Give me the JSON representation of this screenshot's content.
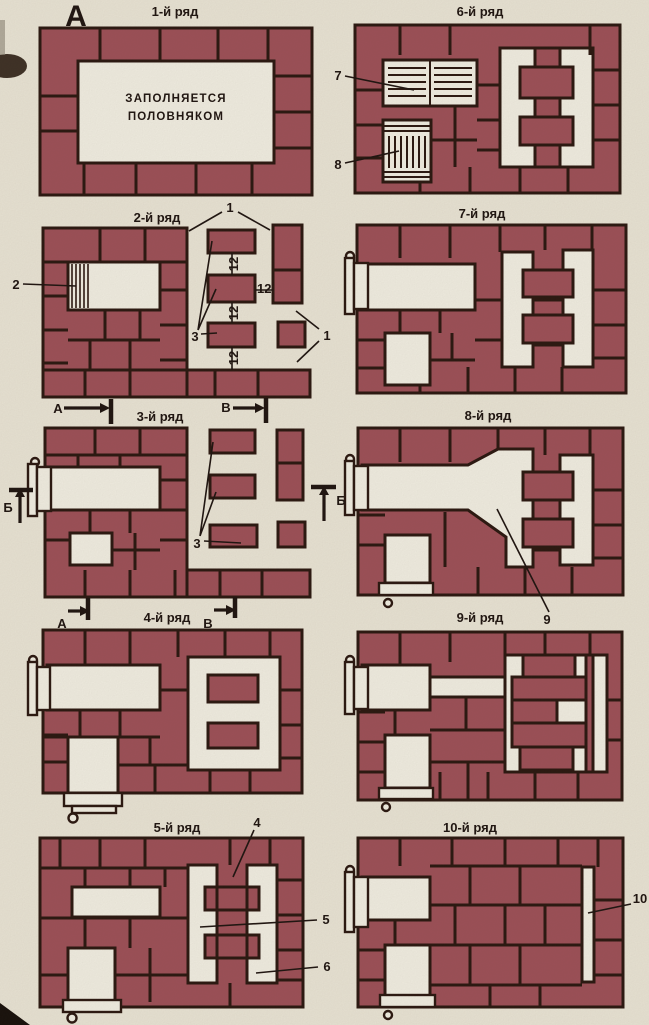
{
  "figure_label": "А",
  "colors": {
    "paper": "#e8e3d4",
    "brick": "#9c4f57",
    "outline": "#2a1710",
    "opening": "#f0ede1",
    "ink": "#1e1410"
  },
  "panels": [
    {
      "title": "1-й ряд",
      "note_line1": "ЗАПОЛНЯЕТСЯ",
      "note_line2": "ПОЛОВНЯКОМ"
    },
    {
      "title": "2-й ряд"
    },
    {
      "title": "3-й ряд"
    },
    {
      "title": "4-й ряд"
    },
    {
      "title": "5-й ряд"
    },
    {
      "title": "6-й ряд"
    },
    {
      "title": "7-й ряд"
    },
    {
      "title": "8-й ряд"
    },
    {
      "title": "9-й ряд"
    },
    {
      "title": "10-й ряд"
    }
  ],
  "callouts": {
    "n1": "1",
    "n2": "2",
    "n3": "3",
    "n4": "4",
    "n5": "5",
    "n6": "6",
    "n7": "7",
    "n8": "8",
    "n9": "9",
    "n10": "10",
    "n12": "12"
  },
  "section_markers": {
    "a": "А",
    "b": "Б",
    "v": "В"
  }
}
